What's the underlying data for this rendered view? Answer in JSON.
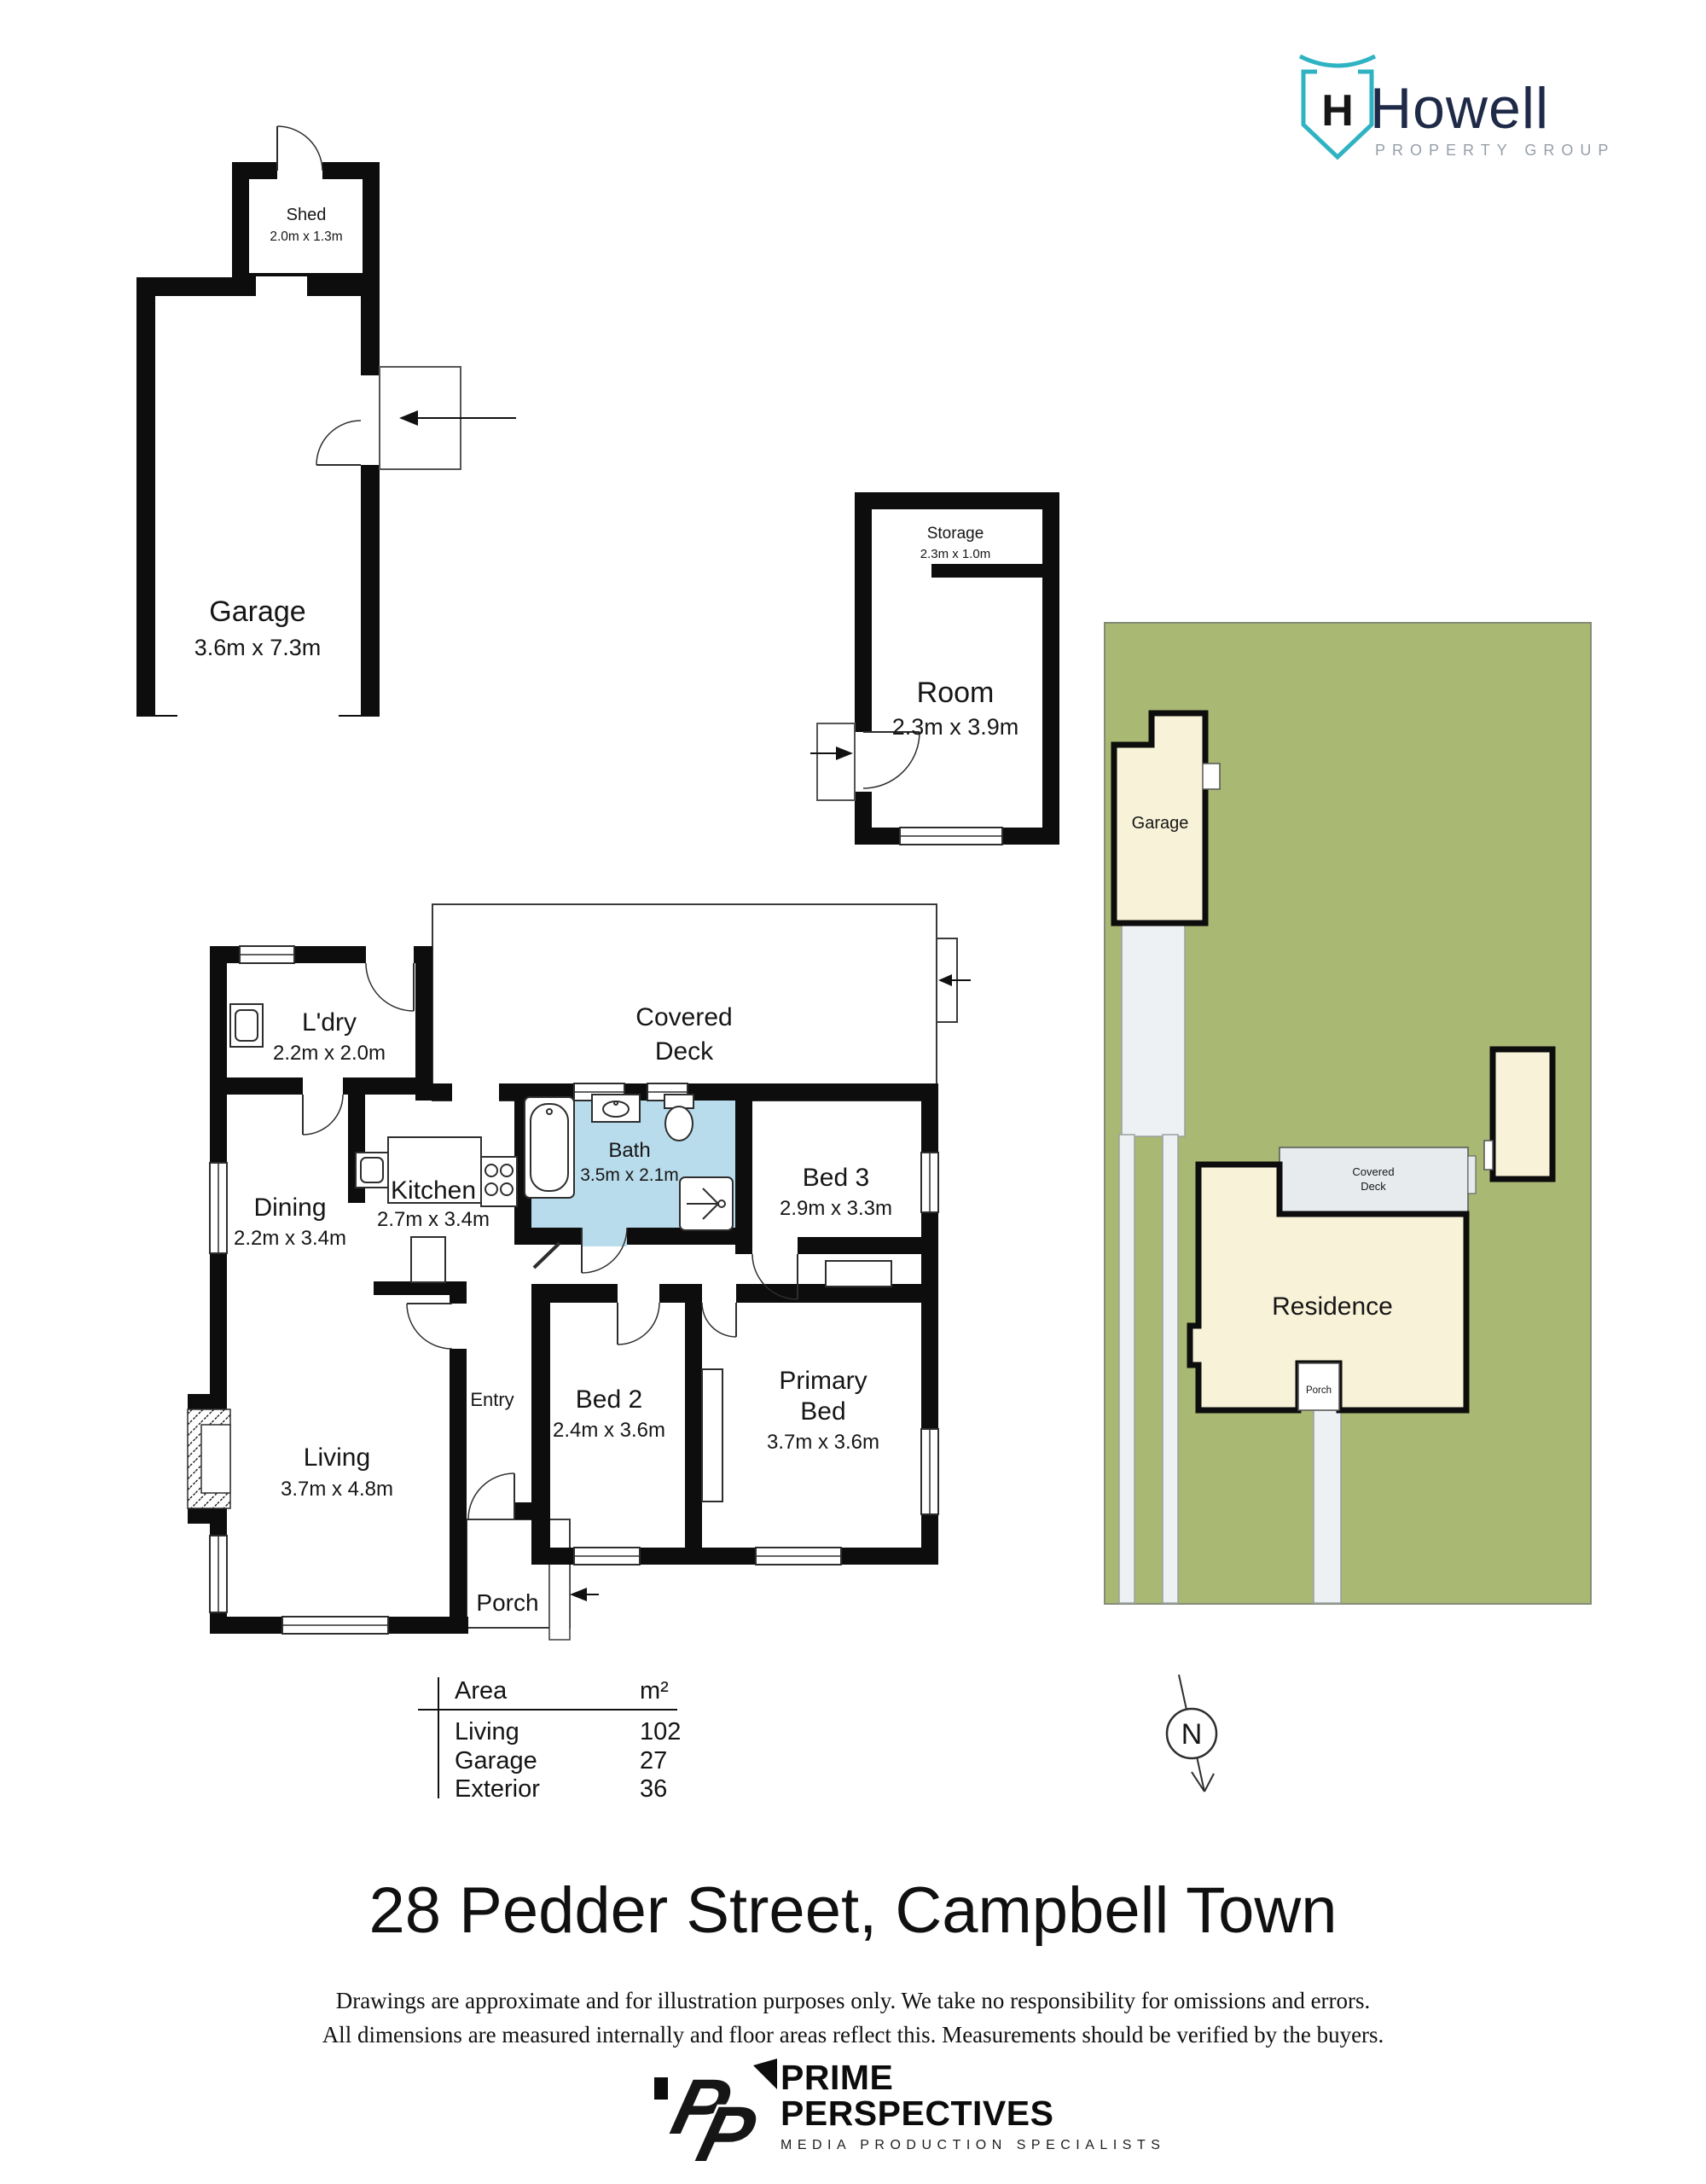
{
  "brand": {
    "name": "Howell",
    "tagline": "PROPERTY GROUP",
    "monogram": "H",
    "teal": "#2fb3c3",
    "navy": "#1e2a47",
    "gray": "#959ea9"
  },
  "garage_plan": {
    "shed": {
      "name": "Shed",
      "dims": "2.0m x 1.3m"
    },
    "garage": {
      "name": "Garage",
      "dims": "3.6m x 7.3m"
    }
  },
  "room_plan": {
    "storage": {
      "name": "Storage",
      "dims": "2.3m x 1.0m"
    },
    "room": {
      "name": "Room",
      "dims": "2.3m x 3.9m"
    }
  },
  "main_plan": {
    "covered_deck": {
      "line1": "Covered",
      "line2": "Deck"
    },
    "ldry": {
      "name": "L'dry",
      "dims": "2.2m x 2.0m"
    },
    "dining": {
      "name": "Dining",
      "dims": "2.2m x 3.4m"
    },
    "kitchen": {
      "name": "Kitchen",
      "dims": "2.7m x 3.4m"
    },
    "bath": {
      "name": "Bath",
      "dims": "3.5m x 2.1m"
    },
    "bed3": {
      "name": "Bed 3",
      "dims": "2.9m x 3.3m"
    },
    "living": {
      "name": "Living",
      "dims": "3.7m x 4.8m"
    },
    "entry": {
      "name": "Entry"
    },
    "bed2": {
      "name": "Bed 2",
      "dims": "2.4m x 3.6m"
    },
    "primary": {
      "line1": "Primary",
      "line2": "Bed",
      "dims": "3.7m x 3.6m"
    },
    "porch": {
      "name": "Porch"
    },
    "bath_color": "#b9dcec"
  },
  "site_plan": {
    "garage_label": "Garage",
    "residence_label": "Residence",
    "covered_deck_line1": "Covered",
    "covered_deck_line2": "Deck",
    "porch_label": "Porch",
    "green": "#a9b873",
    "building_fill": "#f8f3d8",
    "deck_fill": "#e8ebee"
  },
  "area_table": {
    "header": {
      "area": "Area",
      "unit": "m²"
    },
    "rows": [
      {
        "label": "Living",
        "value": "102"
      },
      {
        "label": "Garage",
        "value": "27"
      },
      {
        "label": "Exterior",
        "value": "36"
      }
    ]
  },
  "north": {
    "label": "N"
  },
  "title": "28 Pedder Street, Campbell Town",
  "disclaimer": {
    "line1": "Drawings are approximate and for illustration purposes only. We take no responsibility for omissions and errors.",
    "line2": "All dimensions are measured internally and floor areas reflect this. Measurements should be verified by the buyers."
  },
  "footer_logo": {
    "p1": "P",
    "p2": "P",
    "line1": "PRIME",
    "line2": "PERSPECTIVES",
    "line3": "MEDIA PRODUCTION SPECIALISTS"
  }
}
